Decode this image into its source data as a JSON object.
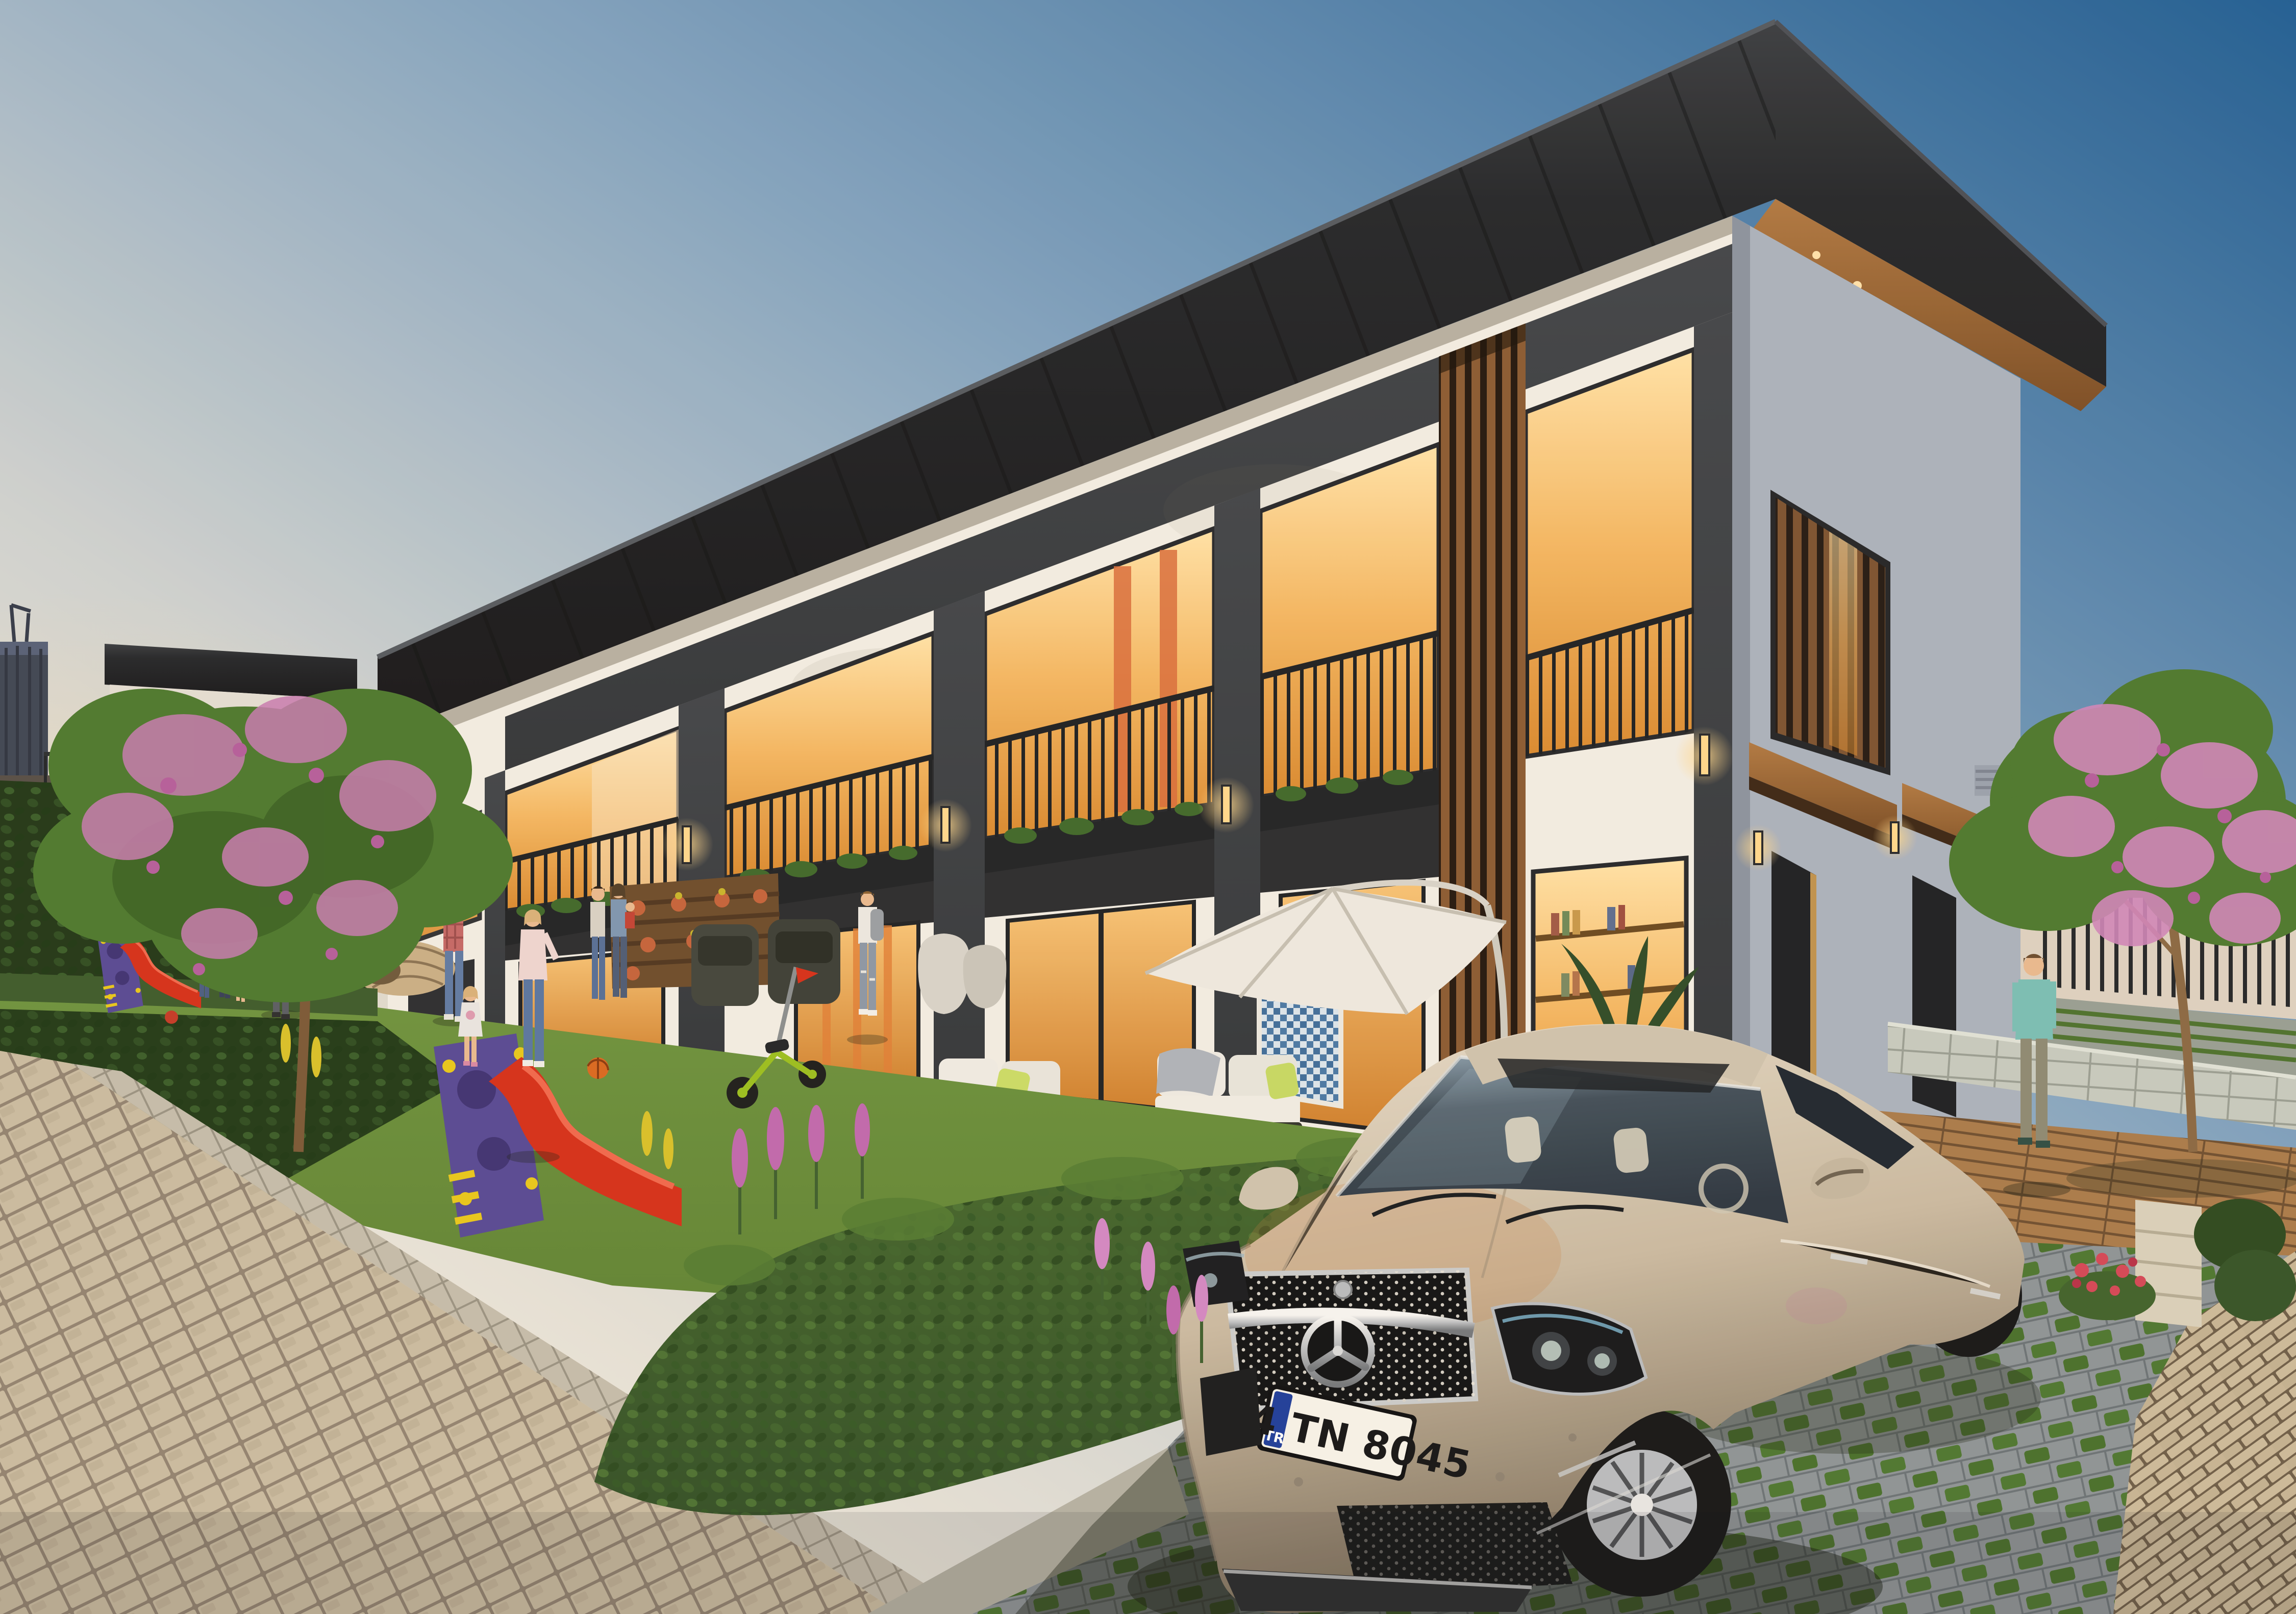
{
  "scene": {
    "type": "exterior-architectural-render",
    "subject": "modern townhouse complex with gardens at dusk",
    "objects": [
      "townhouse-row",
      "city-tower",
      "flowering-trees",
      "garden-lawn",
      "playground-slides",
      "patio-furniture",
      "cantilever-umbrella",
      "residents",
      "mercedes-sedan",
      "cobblestone-path",
      "grass-pavers",
      "perimeter-fence",
      "wood-canopies"
    ]
  },
  "car": {
    "emblem": "mercedes-star",
    "license_plate": {
      "country_code": "TR",
      "number": "34 TN 8045"
    }
  },
  "colors": {
    "sky_deep": "#1f5f97",
    "sky_mid": "#7fa3c2",
    "sky_horizon": "#ece7dc",
    "facade_light": "#f2efe7",
    "facade_shaded": "#aab3c0",
    "roof_dark": "#24282d",
    "marble_dark": "#33383d",
    "wood_warm": "#8a5c36",
    "window_glow": "#f3b763",
    "lawn_green": "#5f8537",
    "hedge_green": "#33522a",
    "path_stone": "#c6b9a1",
    "paver_gray": "#8d9599",
    "car_body": "#c9bba4",
    "car_glass": "#2c3844",
    "plate_band_blue": "#1e3f9e",
    "slide_red": "#d5311d",
    "play_purple": "#574a97",
    "blossom_pink": "#c77cb4",
    "umbrella_white": "#eeebe3"
  }
}
